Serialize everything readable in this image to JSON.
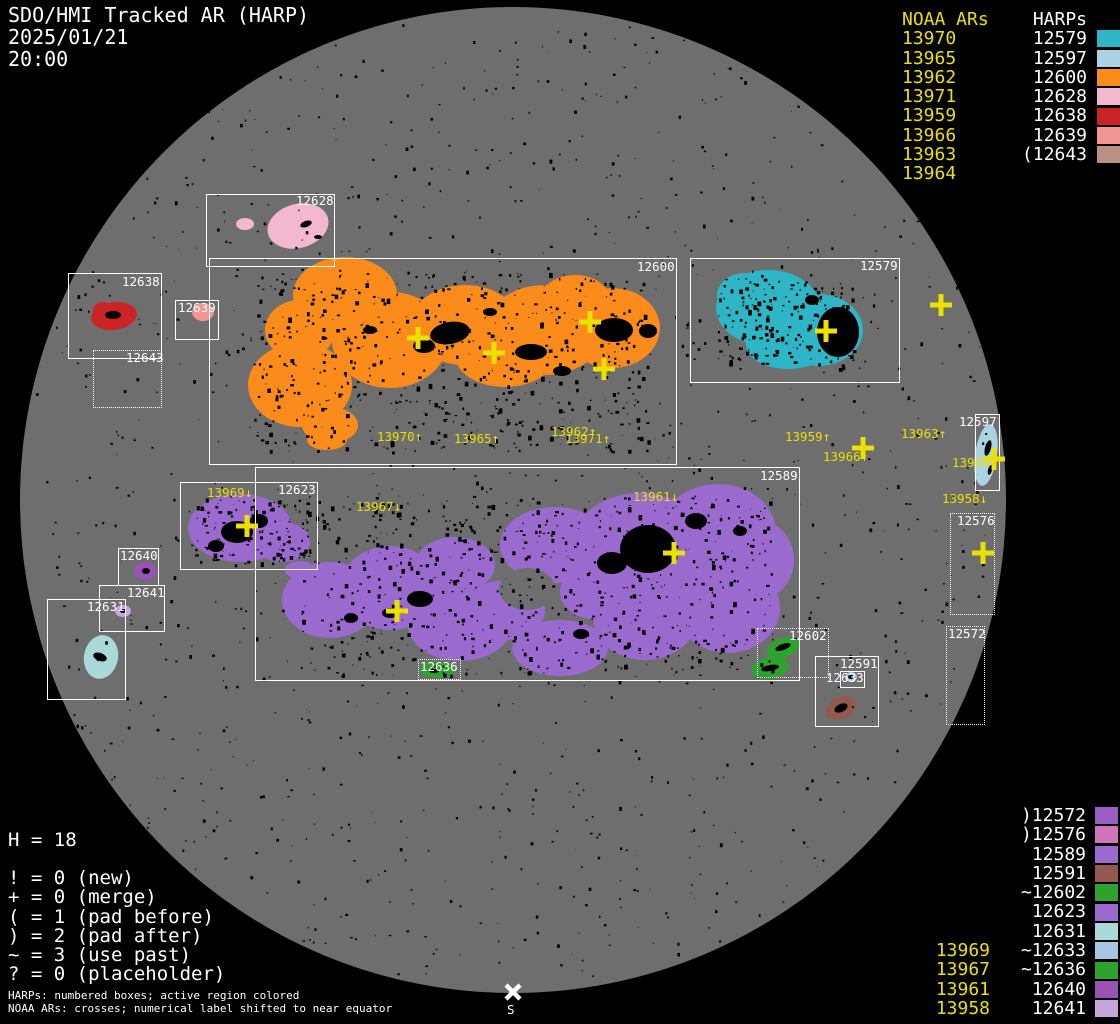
{
  "header": {
    "title": "SDO/HMI Tracked AR (HARP)",
    "date": "2025/01/21",
    "time": "20:00"
  },
  "legend_top_right": {
    "noaa_header": "NOAA ARs",
    "harp_header": "HARPs",
    "rows": [
      {
        "noaa": "13970",
        "harp": "12579",
        "color": "#2eb6c6"
      },
      {
        "noaa": "13965",
        "harp": "12597",
        "color": "#abd3e3"
      },
      {
        "noaa": "13962",
        "harp": "12600",
        "color": "#fb8b1a"
      },
      {
        "noaa": "13971",
        "harp": "12628",
        "color": "#f3b7cf"
      },
      {
        "noaa": "13959",
        "harp": "12638",
        "color": "#cb2427"
      },
      {
        "noaa": "13966",
        "harp": "12639",
        "color": "#f29394"
      },
      {
        "noaa": "13963",
        "harp": "(12643",
        "color": "#bb8e86"
      },
      {
        "noaa": "13964",
        "harp": "",
        "color": ""
      }
    ]
  },
  "legend_bottom_right": {
    "rows": [
      {
        "noaa": "",
        "harp": ")12572",
        "color": "#9a5ec4"
      },
      {
        "noaa": "",
        "harp": ")12576",
        "color": "#d274bd"
      },
      {
        "noaa": "",
        "harp": "12589",
        "color": "#9a6ace"
      },
      {
        "noaa": "",
        "harp": "12591",
        "color": "#93594f"
      },
      {
        "noaa": "",
        "harp": "~12602",
        "color": "#2ea12e"
      },
      {
        "noaa": "",
        "harp": "12623",
        "color": "#9a6ace"
      },
      {
        "noaa": "",
        "harp": "12631",
        "color": "#aad9da"
      },
      {
        "noaa": "13969",
        "harp": "~12633",
        "color": "#a6c6e6"
      },
      {
        "noaa": "13967",
        "harp": "~12636",
        "color": "#2ea12e"
      },
      {
        "noaa": "13961",
        "harp": "12640",
        "color": "#9a52b4"
      },
      {
        "noaa": "13958",
        "harp": "12641",
        "color": "#c9a5de"
      }
    ]
  },
  "legend_bottom_left": {
    "h_count": "H = 18",
    "lines": [
      "! = 0 (new)",
      "+ = 0 (merge)",
      "( = 1 (pad before)",
      ") = 2 (pad after)",
      "~ = 3 (use past)",
      "? = 0 (placeholder)"
    ],
    "footer": [
      "HARPs: numbered boxes; active region colored",
      "NOAA ARs: crosses; numerical label shifted to near equator"
    ]
  },
  "south_marker": {
    "label": "S"
  },
  "colors": {
    "yellow": "#ebe100",
    "white": "#ffffff",
    "disk": "#6e6e6e"
  },
  "harp_boxes": [
    {
      "label": "12628",
      "x": 206,
      "y": 194,
      "w": 127,
      "h": 71,
      "style": "solid",
      "lx": 296,
      "ly": 195
    },
    {
      "label": "12638",
      "x": 68,
      "y": 273,
      "w": 92,
      "h": 84,
      "style": "solid",
      "lx": 122,
      "ly": 276
    },
    {
      "label": "12643",
      "x": 93,
      "y": 350,
      "w": 67,
      "h": 56,
      "style": "dotted",
      "lx": 126,
      "ly": 352
    },
    {
      "label": "12639",
      "x": 175,
      "y": 300,
      "w": 42,
      "h": 38,
      "style": "solid",
      "lx": 178,
      "ly": 302
    },
    {
      "label": "12600",
      "x": 209,
      "y": 258,
      "w": 466,
      "h": 205,
      "style": "solid",
      "lx": 637,
      "ly": 261
    },
    {
      "label": "12579",
      "x": 690,
      "y": 258,
      "w": 208,
      "h": 123,
      "style": "solid",
      "lx": 860,
      "ly": 260
    },
    {
      "label": "12597",
      "x": 975,
      "y": 414,
      "w": 23,
      "h": 75,
      "style": "solid",
      "lx": 959,
      "ly": 416
    },
    {
      "label": "12576",
      "x": 950,
      "y": 513,
      "w": 43,
      "h": 100,
      "style": "dotted",
      "lx": 957,
      "ly": 515
    },
    {
      "label": "12572",
      "x": 946,
      "y": 626,
      "w": 37,
      "h": 97,
      "style": "dotted",
      "lx": 948,
      "ly": 628
    },
    {
      "label": "12623",
      "x": 180,
      "y": 482,
      "w": 136,
      "h": 86,
      "style": "solid",
      "lx": 278,
      "ly": 484
    },
    {
      "label": "12589",
      "x": 255,
      "y": 467,
      "w": 543,
      "h": 212,
      "style": "solid",
      "lx": 760,
      "ly": 470
    },
    {
      "label": "12640",
      "x": 118,
      "y": 548,
      "w": 39,
      "h": 36,
      "style": "solid",
      "lx": 120,
      "ly": 550
    },
    {
      "label": "12641",
      "x": 99,
      "y": 585,
      "w": 64,
      "h": 45,
      "style": "solid",
      "lx": 127,
      "ly": 587
    },
    {
      "label": "12631",
      "x": 47,
      "y": 599,
      "w": 77,
      "h": 99,
      "style": "solid",
      "lx": 87,
      "ly": 601
    },
    {
      "label": "12602",
      "x": 757,
      "y": 628,
      "w": 70,
      "h": 48,
      "style": "dotted",
      "lx": 789,
      "ly": 630
    },
    {
      "label": "12591",
      "x": 815,
      "y": 656,
      "w": 62,
      "h": 69,
      "style": "solid",
      "lx": 840,
      "ly": 658
    },
    {
      "label": "12633",
      "x": 840,
      "y": 671,
      "w": 23,
      "h": 15,
      "style": "solid",
      "lx": 826,
      "ly": 672
    },
    {
      "label": "12636",
      "x": 418,
      "y": 659,
      "w": 41,
      "h": 19,
      "style": "dotted",
      "lx": 420,
      "ly": 661
    }
  ],
  "ar_labels": [
    {
      "text": "13970↑",
      "x": 377,
      "y": 431
    },
    {
      "text": "13965↑",
      "x": 454,
      "y": 433
    },
    {
      "text": "13962↑",
      "x": 551,
      "y": 426
    },
    {
      "text": "13971↑",
      "x": 565,
      "y": 433
    },
    {
      "text": "13967↓",
      "x": 356,
      "y": 501
    },
    {
      "text": "13961↓",
      "x": 633,
      "y": 491
    },
    {
      "text": "13959↑",
      "x": 785,
      "y": 431
    },
    {
      "text": "13966↑",
      "x": 823,
      "y": 451
    },
    {
      "text": "13963↑",
      "x": 901,
      "y": 428
    },
    {
      "text": "13964↑",
      "x": 952,
      "y": 457
    },
    {
      "text": "13958↓",
      "x": 942,
      "y": 493
    },
    {
      "text": "13969↓",
      "x": 207,
      "y": 487
    }
  ],
  "noaa_crosses": [
    {
      "x": 418,
      "y": 338
    },
    {
      "x": 494,
      "y": 353
    },
    {
      "x": 590,
      "y": 322
    },
    {
      "x": 604,
      "y": 369
    },
    {
      "x": 826,
      "y": 331
    },
    {
      "x": 941,
      "y": 305
    },
    {
      "x": 863,
      "y": 448
    },
    {
      "x": 994,
      "y": 459
    },
    {
      "x": 983,
      "y": 553
    },
    {
      "x": 247,
      "y": 526
    },
    {
      "x": 397,
      "y": 611
    },
    {
      "x": 674,
      "y": 553
    }
  ],
  "regions": [
    {
      "harp": "12600",
      "color": "#fb8b1a",
      "ellipses": [
        [
          345,
          295,
          52,
          38,
          0
        ],
        [
          300,
          385,
          52,
          42,
          0
        ],
        [
          390,
          340,
          58,
          48,
          0
        ],
        [
          300,
          330,
          35,
          30,
          0
        ],
        [
          465,
          325,
          55,
          40,
          0
        ],
        [
          545,
          330,
          60,
          45,
          0
        ],
        [
          612,
          328,
          48,
          40,
          0
        ],
        [
          505,
          355,
          50,
          32,
          0
        ],
        [
          575,
          300,
          35,
          25,
          0
        ],
        [
          330,
          425,
          28,
          18,
          0
        ],
        [
          327,
          440,
          20,
          10,
          0
        ]
      ]
    },
    {
      "harp": "12589",
      "color": "#9a6ace",
      "ellipses": [
        [
          330,
          600,
          48,
          38,
          0
        ],
        [
          390,
          588,
          50,
          42,
          0
        ],
        [
          460,
          625,
          52,
          36,
          0
        ],
        [
          455,
          565,
          40,
          28,
          0
        ],
        [
          555,
          545,
          55,
          38,
          0
        ],
        [
          640,
          545,
          68,
          52,
          0
        ],
        [
          718,
          532,
          58,
          48,
          0
        ],
        [
          728,
          608,
          52,
          45,
          0
        ],
        [
          645,
          618,
          52,
          42,
          0
        ],
        [
          560,
          648,
          48,
          28,
          0
        ],
        [
          598,
          592,
          38,
          28,
          0
        ],
        [
          762,
          560,
          32,
          38,
          0
        ],
        [
          505,
          610,
          40,
          30,
          0
        ]
      ]
    },
    {
      "harp": "12589-gap",
      "color": "#6e6e6e",
      "ellipses": [
        [
          527,
          589,
          28,
          21,
          0
        ]
      ]
    },
    {
      "harp": "12623",
      "color": "#9a6ace",
      "ellipses": [
        [
          240,
          528,
          52,
          34,
          0
        ],
        [
          282,
          542,
          28,
          20,
          0
        ],
        [
          300,
          570,
          15,
          9,
          0
        ]
      ]
    },
    {
      "harp": "12579",
      "color": "#2eb6c6",
      "ellipses": [
        [
          768,
          308,
          52,
          38,
          0
        ],
        [
          818,
          330,
          45,
          36,
          0
        ],
        [
          745,
          295,
          28,
          22,
          0
        ],
        [
          788,
          345,
          42,
          24,
          0
        ]
      ]
    },
    {
      "harp": "12628",
      "color": "#f3b7cf",
      "ellipses": [
        [
          298,
          226,
          31,
          22,
          -15
        ],
        [
          245,
          224,
          9,
          6,
          0
        ]
      ]
    },
    {
      "harp": "12638",
      "color": "#cb2427",
      "ellipses": [
        [
          114,
          316,
          23,
          14,
          -8
        ],
        [
          103,
          310,
          10,
          8,
          0
        ]
      ]
    },
    {
      "harp": "12639",
      "color": "#f29394",
      "ellipses": [
        [
          203,
          312,
          11,
          9,
          0
        ]
      ]
    },
    {
      "harp": "12597",
      "color": "#abd3e3",
      "ellipses": [
        [
          986,
          455,
          11,
          31,
          8
        ]
      ]
    },
    {
      "harp": "12602",
      "color": "#2ea12e",
      "ellipses": [
        [
          783,
          648,
          17,
          10,
          -20
        ],
        [
          770,
          668,
          19,
          11,
          -10
        ]
      ]
    },
    {
      "harp": "12636",
      "color": "#2ea12e",
      "ellipses": [
        [
          437,
          670,
          18,
          8,
          0
        ]
      ]
    },
    {
      "harp": "12591",
      "color": "#93594f",
      "ellipses": [
        [
          841,
          708,
          16,
          11,
          -25
        ]
      ]
    },
    {
      "harp": "12633",
      "color": "#a6c6e6",
      "ellipses": [
        [
          851,
          677,
          6,
          5,
          0
        ]
      ]
    },
    {
      "harp": "12640",
      "color": "#9a52b4",
      "ellipses": [
        [
          145,
          571,
          11,
          9,
          0
        ]
      ]
    },
    {
      "harp": "12641",
      "color": "#c9a5de",
      "ellipses": [
        [
          123,
          611,
          8,
          6,
          0
        ]
      ]
    },
    {
      "harp": "12631",
      "color": "#aad9da",
      "ellipses": [
        [
          101,
          657,
          17,
          22,
          10
        ]
      ]
    }
  ],
  "sunspots": [
    [
      450,
      333,
      20,
      11,
      -10
    ],
    [
      424,
      346,
      11,
      7,
      0
    ],
    [
      531,
      352,
      16,
      8,
      0
    ],
    [
      614,
      330,
      19,
      12,
      0
    ],
    [
      648,
      331,
      9,
      7,
      0
    ],
    [
      490,
      312,
      7,
      4,
      0
    ],
    [
      562,
      371,
      9,
      5,
      0
    ],
    [
      370,
      330,
      7,
      4,
      0
    ],
    [
      838,
      332,
      21,
      25,
      0
    ],
    [
      812,
      300,
      7,
      5,
      0
    ],
    [
      648,
      549,
      28,
      24,
      0
    ],
    [
      612,
      563,
      15,
      11,
      0
    ],
    [
      696,
      521,
      11,
      8,
      0
    ],
    [
      420,
      599,
      13,
      8,
      0
    ],
    [
      390,
      613,
      8,
      5,
      0
    ],
    [
      351,
      618,
      7,
      5,
      0
    ],
    [
      581,
      634,
      8,
      5,
      0
    ],
    [
      740,
      531,
      7,
      5,
      0
    ],
    [
      237,
      532,
      16,
      11,
      0
    ],
    [
      259,
      521,
      9,
      7,
      0
    ],
    [
      216,
      546,
      8,
      6,
      0
    ],
    [
      306,
      224,
      6,
      3,
      -20
    ],
    [
      318,
      237,
      4,
      2,
      0
    ],
    [
      988,
      448,
      3,
      8,
      15
    ],
    [
      990,
      470,
      2,
      5,
      15
    ],
    [
      113,
      315,
      8,
      4,
      0
    ],
    [
      783,
      647,
      8,
      3,
      -20
    ],
    [
      770,
      668,
      9,
      3,
      -10
    ],
    [
      434,
      671,
      5,
      2,
      0
    ],
    [
      841,
      708,
      7,
      4,
      -25
    ],
    [
      146,
      571,
      4,
      3,
      0
    ],
    [
      100,
      657,
      7,
      4,
      20
    ],
    [
      851,
      677,
      3,
      2,
      0
    ],
    [
      123,
      611,
      3,
      2,
      0
    ]
  ]
}
